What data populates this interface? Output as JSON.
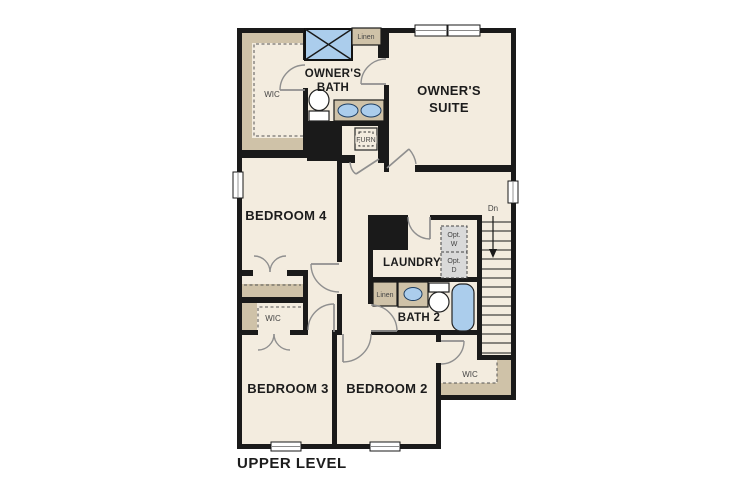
{
  "title": "UPPER LEVEL",
  "colors": {
    "background": "#ffffff",
    "floor": "#f3ecdf",
    "wall": "#1a1a1a",
    "shelf": "#cfc2a8",
    "fixture_blue": "#abcdec",
    "door_swing": "#8f8f8f",
    "window": "#ffffff",
    "opt_fill": "#d9d9d9",
    "label": "#1c1c1c",
    "label_muted": "#454545"
  },
  "rooms": {
    "owners_suite": {
      "line1": "OWNER'S",
      "line2": "SUITE"
    },
    "owners_bath": {
      "line1": "OWNER'S",
      "line2": "BATH"
    },
    "owners_wic": {
      "label": "WIC"
    },
    "bedroom4": {
      "label": "BEDROOM 4"
    },
    "bedroom3": {
      "label": "BEDROOM 3"
    },
    "bedroom2": {
      "label": "BEDROOM 2"
    },
    "laundry": {
      "label": "LAUNDRY"
    },
    "bath2": {
      "label": "BATH 2"
    },
    "wic_bedroom3": {
      "label": "WIC"
    },
    "wic_bedroom2": {
      "label": "WIC"
    }
  },
  "closets": {
    "linen_owners_bath": "Linen",
    "linen_bath2": "Linen"
  },
  "utility": {
    "furnace": "FURN",
    "opt_washer_line1": "Opt.",
    "opt_washer_line2": "W",
    "opt_dryer_line1": "Opt.",
    "opt_dryer_line2": "D"
  },
  "stairs": {
    "down_label": "Dn"
  }
}
